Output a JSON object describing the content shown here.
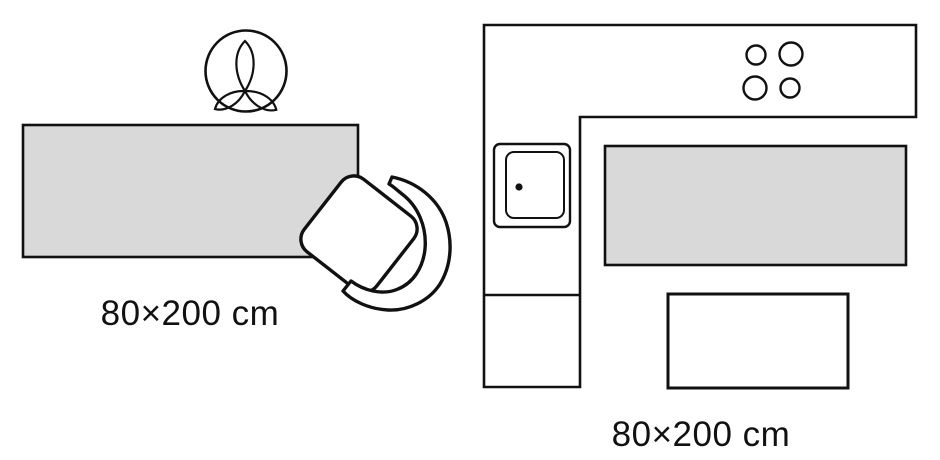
{
  "diagram": {
    "title": "rug-size-placement-diagram",
    "colors": {
      "background": "#ffffff",
      "line": "#111111",
      "rug_fill": "#d9d9d9"
    },
    "scenes": {
      "left": {
        "name": "runner rug with chair and potted plant (top view)",
        "size_label": "80×200 cm",
        "icons": [
          "plant-top-view-icon",
          "chair-top-view-icon",
          "rug-swatch"
        ]
      },
      "right": {
        "name": "kitchen with L-shaped counter (top view)",
        "size_label": "80×200 cm",
        "icons": [
          "counter-outline",
          "sink-icon",
          "stove-burners-icon",
          "rug-swatch",
          "table-outline"
        ]
      }
    }
  }
}
